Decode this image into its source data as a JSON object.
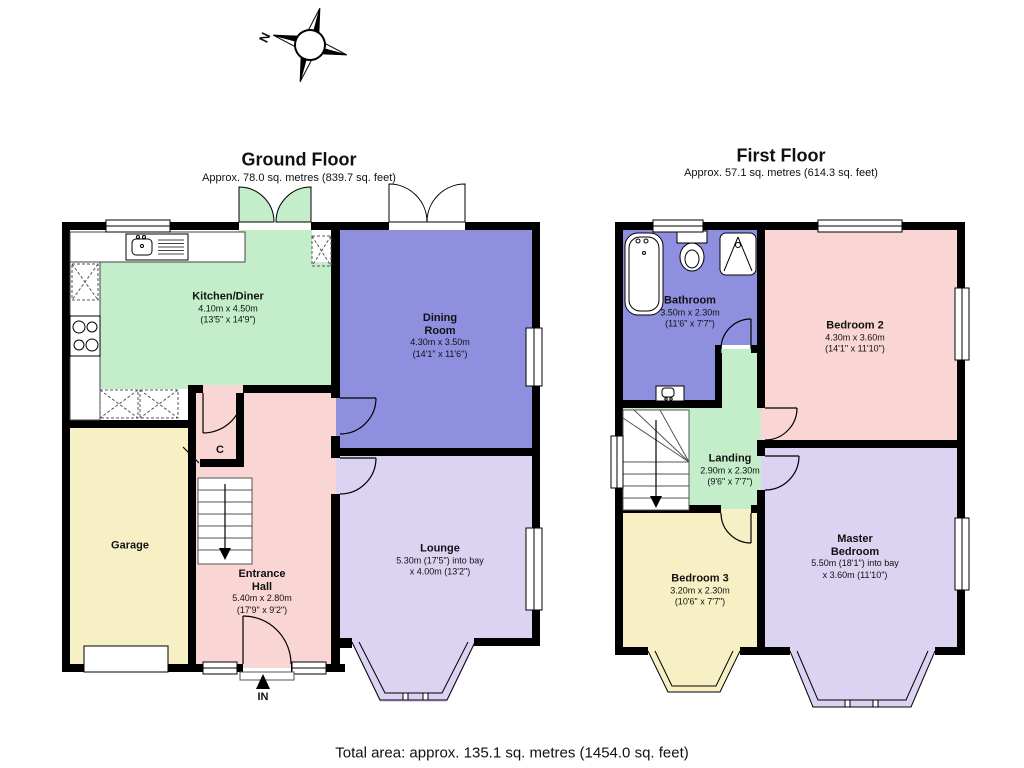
{
  "compass": {
    "north_label": "N"
  },
  "ground_floor": {
    "title": "Ground Floor",
    "subtitle": "Approx. 78.0 sq. metres (839.7 sq. feet)",
    "rooms": {
      "kitchen": {
        "name": "Kitchen/Diner",
        "dims": "4.10m x 4.50m\n(13'5\" x 14'9\")"
      },
      "dining": {
        "name": "Dining\nRoom",
        "dims": "4.30m x 3.50m\n(14'1\" x 11'6\")"
      },
      "lounge": {
        "name": "Lounge",
        "dims": "5.30m (17'5\") into bay\nx 4.00m (13'2\")"
      },
      "hall": {
        "name": "Entrance\nHall",
        "dims": "5.40m x 2.80m\n(17'9\" x 9'2\")"
      },
      "garage": {
        "name": "Garage"
      },
      "cupboard": {
        "name": "C"
      }
    },
    "entrance_label": "IN"
  },
  "first_floor": {
    "title": "First Floor",
    "subtitle": "Approx. 57.1 sq. metres (614.3 sq. feet)",
    "rooms": {
      "bathroom": {
        "name": "Bathroom",
        "dims": "3.50m x 2.30m\n(11'6\" x 7'7\")"
      },
      "bedroom2": {
        "name": "Bedroom 2",
        "dims": "4.30m x 3.60m\n(14'1\" x 11'10\")"
      },
      "landing": {
        "name": "Landing",
        "dims": "2.90m x 2.30m\n(9'6\" x 7'7\")"
      },
      "bedroom3": {
        "name": "Bedroom 3",
        "dims": "3.20m x 2.30m\n(10'6\" x 7'7\")"
      },
      "master": {
        "name": "Master\nBedroom",
        "dims": "5.50m (18'1\") into bay\nx 3.60m (11'10\")"
      }
    }
  },
  "footer": {
    "total_area": "Total area: approx. 135.1 sq. metres (1454.0 sq. feet)"
  },
  "colors": {
    "green": "#c4edca",
    "blue": "#8f8fe0",
    "pink": "#f9d6d4",
    "yellow": "#f7f0c5",
    "lavender": "#dcd2f1",
    "wall": "#000000"
  }
}
